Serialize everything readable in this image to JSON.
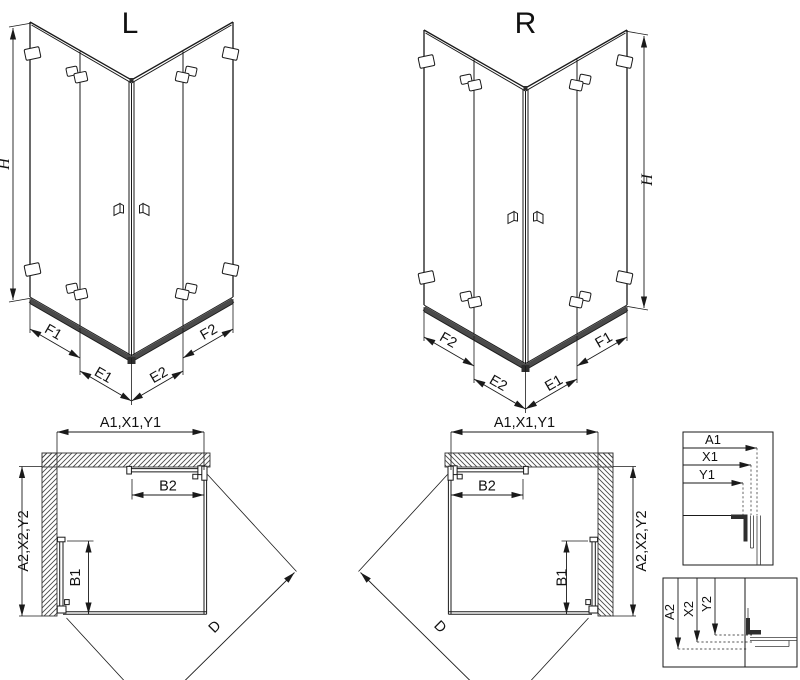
{
  "drawing": {
    "subject": "corner shower enclosure with bi-fold doors, L and R versions, isometric and plan views",
    "colors": {
      "line": "#1a1a1a",
      "rail": "#4a4a4a",
      "background": "#ffffff"
    }
  },
  "iso_views": {
    "left": {
      "title": "L",
      "height_label": "H",
      "bottom_labels": [
        "F1",
        "E1",
        "E2",
        "F2"
      ]
    },
    "right": {
      "title": "R",
      "height_label": "H",
      "bottom_labels": [
        "F2",
        "E2",
        "E1",
        "F1"
      ]
    }
  },
  "plan_views": {
    "left": {
      "top_dim": "A1,X1,Y1",
      "side_dim": "A2,X2,Y2",
      "door_top_dim": "B2",
      "door_side_dim": "B1",
      "diagonal_dim": "D"
    },
    "right": {
      "top_dim": "A1,X1,Y1",
      "side_dim": "A2,X2,Y2",
      "door_top_dim": "B2",
      "door_side_dim": "B1",
      "diagonal_dim": "D"
    }
  },
  "detail_boxes": {
    "horizontal": {
      "labels": [
        "A1",
        "X1",
        "Y1"
      ]
    },
    "vertical": {
      "labels": [
        "A2",
        "X2",
        "Y2"
      ]
    }
  }
}
